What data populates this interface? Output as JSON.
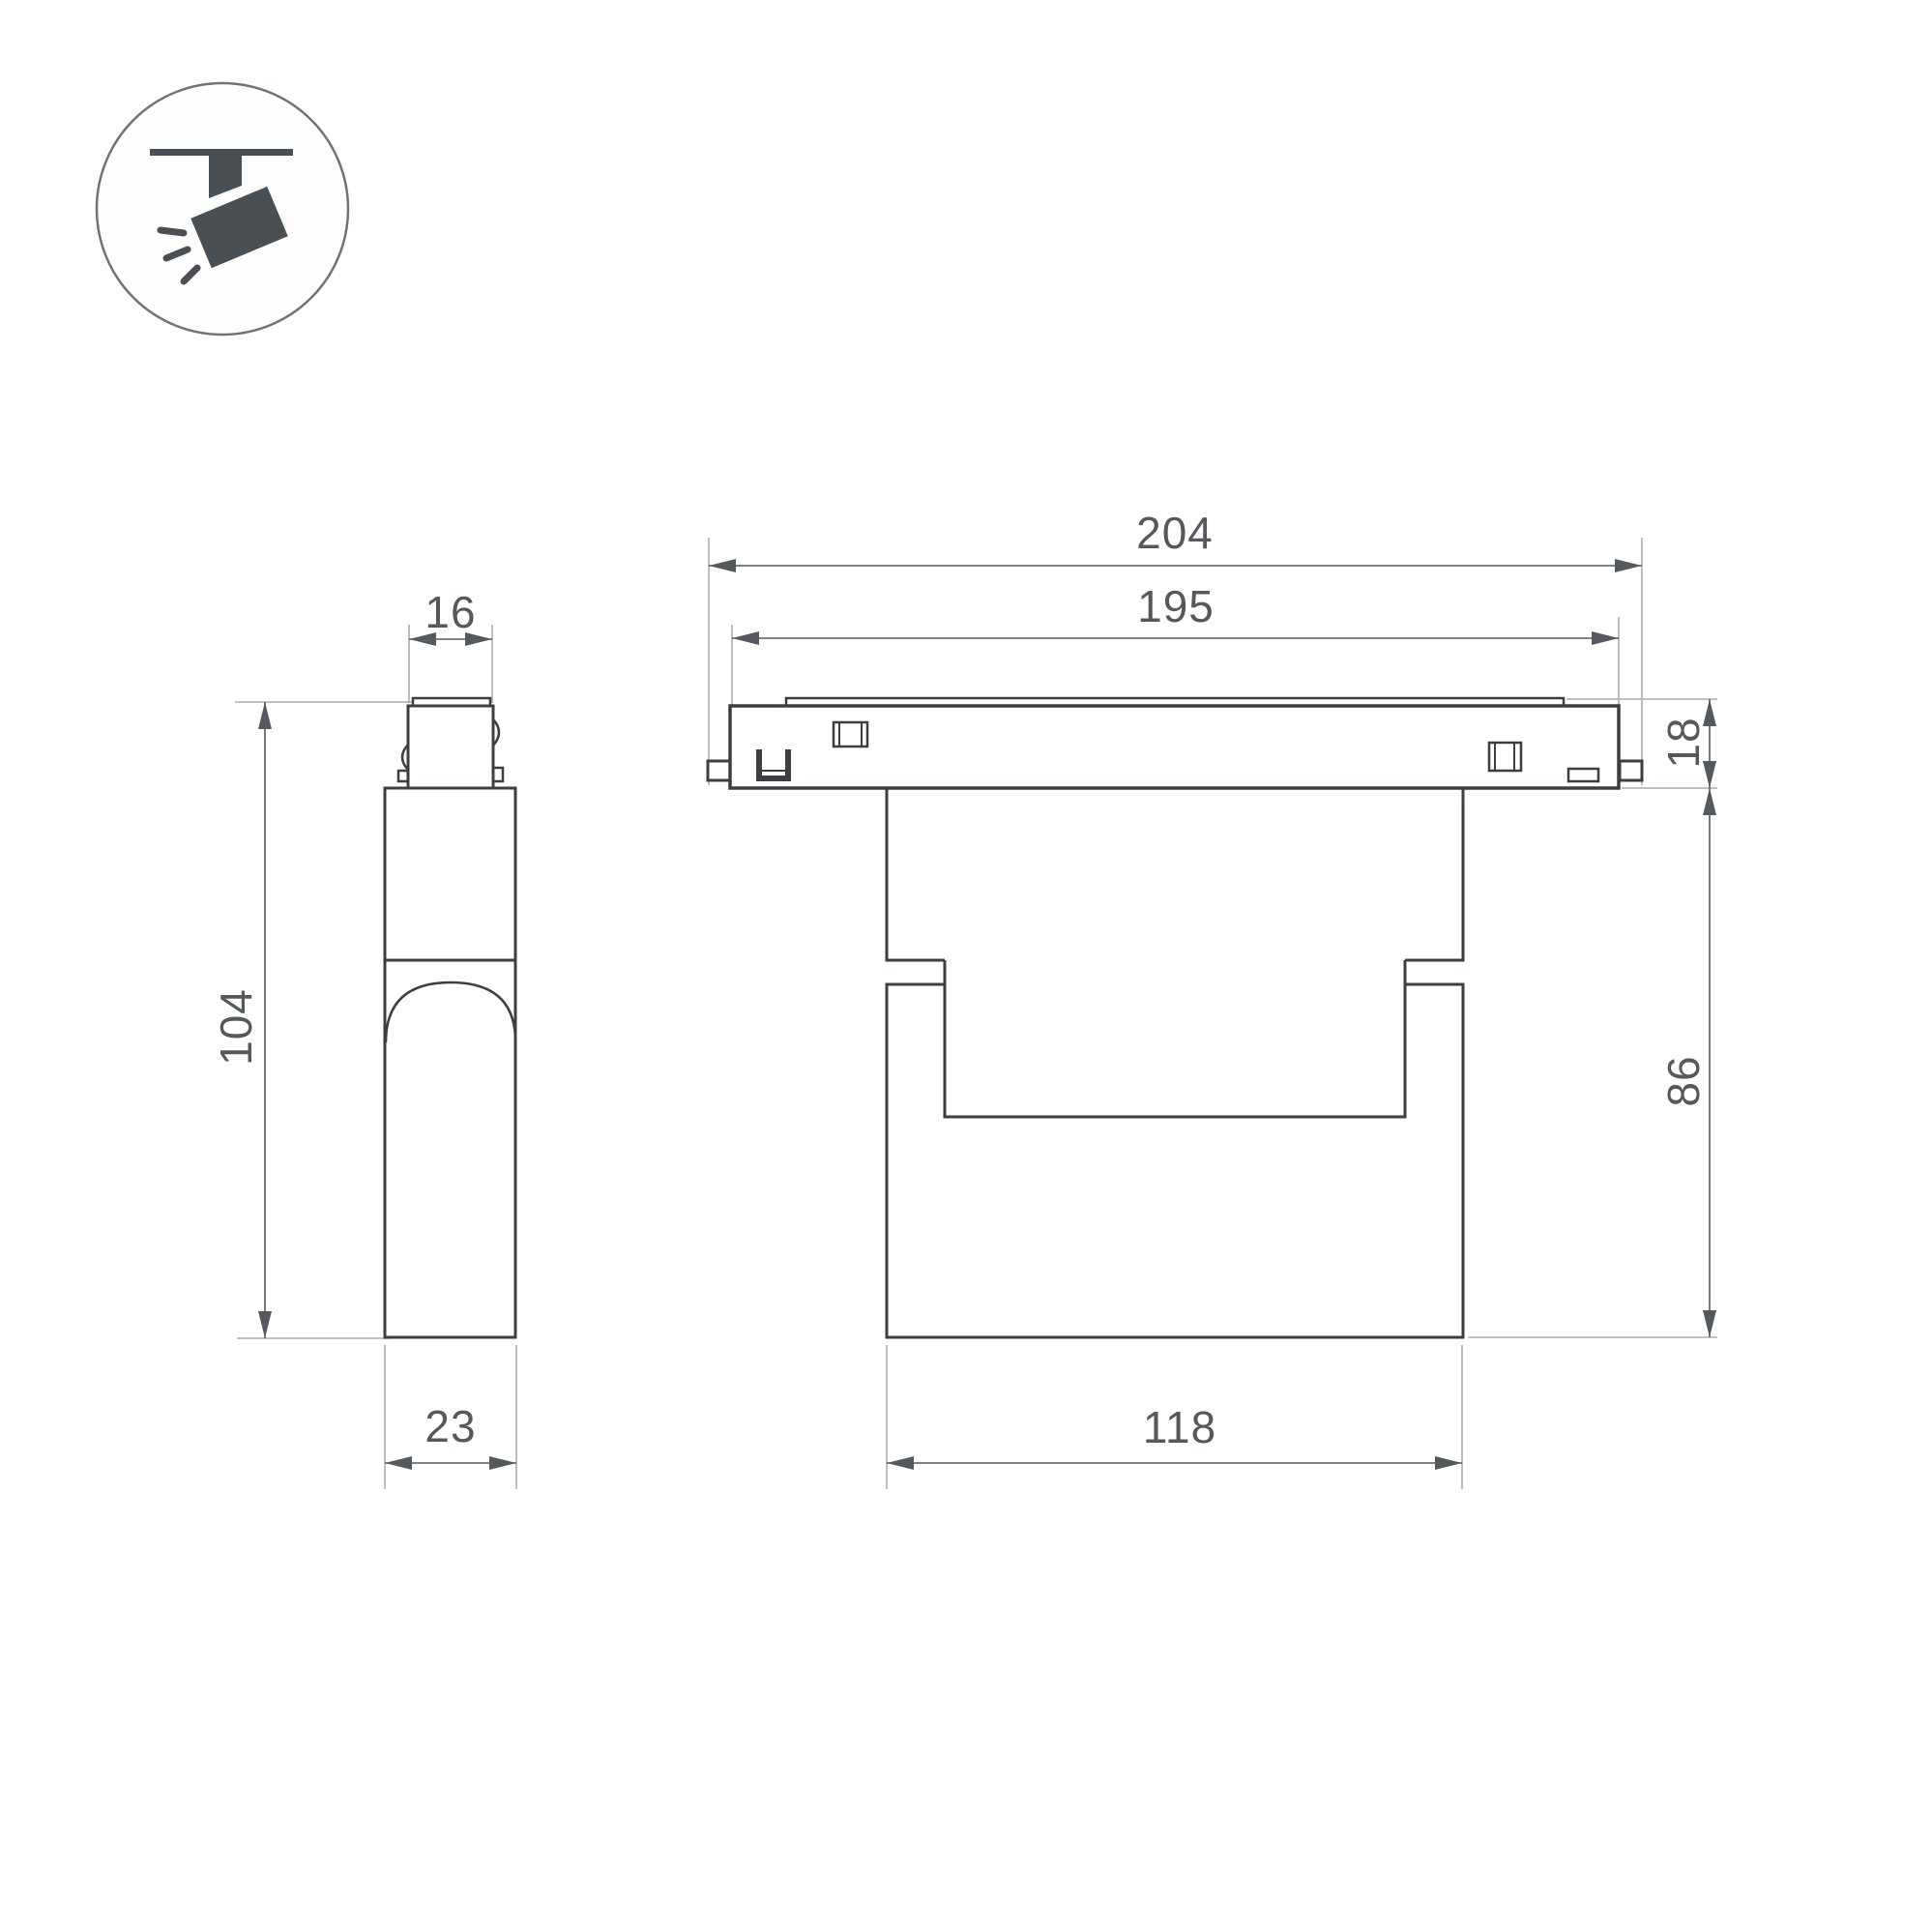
{
  "drawing": {
    "kind": "luminaire-dimension-drawing",
    "views": [
      "side-view",
      "front-view"
    ]
  },
  "icon": {
    "name": "track-spotlight-icon"
  },
  "dimensions": {
    "front_overall_width": "204",
    "front_track_plate_width": "195",
    "front_adapter_height": "18",
    "front_body_height": "86",
    "front_body_width": "118",
    "side_connector_width": "16",
    "side_overall_height": "104",
    "side_body_depth": "23"
  },
  "colors": {
    "outline": "#3b3f44",
    "dim_line": "#55595d",
    "ext_line": "#a9adaf",
    "text": "#55595d",
    "icon_fill": "#4a4f54",
    "icon_circle_stroke": "#6e7377",
    "background": "#ffffff"
  }
}
